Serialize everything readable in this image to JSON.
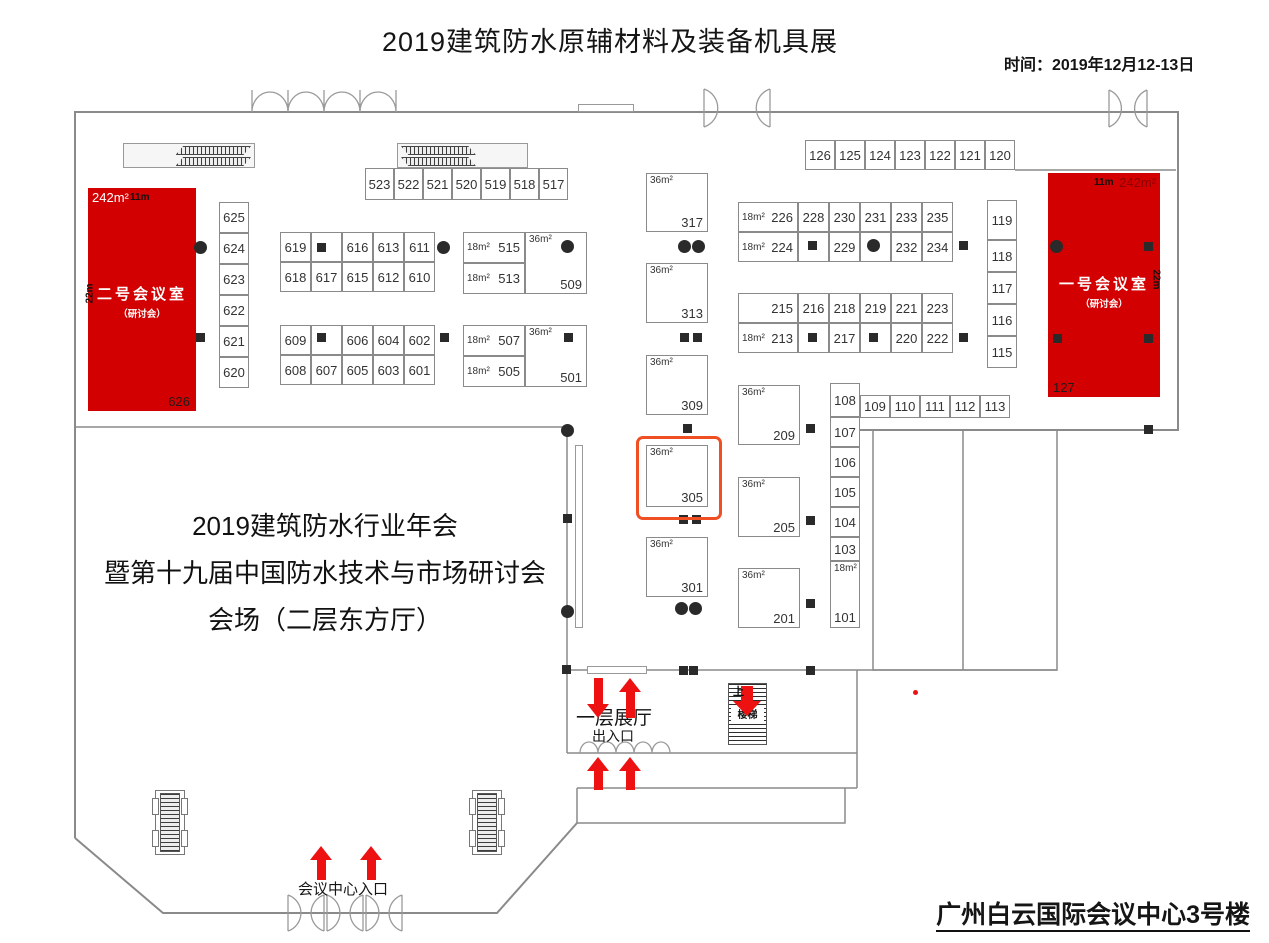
{
  "header": {
    "title": "2019建筑防水原辅材料及装备机具展",
    "time": "时间：2019年12月12-13日"
  },
  "footer": {
    "venue": "广州白云国际会议中心3号楼"
  },
  "annual_meeting": {
    "line1": "2019建筑防水行业年会",
    "line2": "暨第十九届中国防水技术与市场研讨会",
    "line3": "会场（二层东方厅）"
  },
  "labels": {
    "floor_hall": "一层展厅",
    "entrance_exit": "出入口",
    "center_entrance": "会议中心入口",
    "stairs": "楼梯",
    "up": "上"
  },
  "highlighted_booth": "305",
  "colors": {
    "room_red": "#d20000",
    "arrow_red": "#ee1111",
    "orange": "#f04f24",
    "wall": "#8a8a8a"
  },
  "conference_rooms": [
    {
      "name": "二号会议室",
      "subtitle": "（研讨会）",
      "area": "242m²",
      "width": "11m",
      "depth": "22m",
      "booth": "626"
    },
    {
      "name": "一号会议室",
      "subtitle": "（研讨会）",
      "area": "242m²",
      "width": "11m",
      "depth": "22m",
      "booth": "127"
    }
  ],
  "booths": [
    {
      "no": "523",
      "t": "c",
      "x": 365,
      "y": 168,
      "w": 29,
      "h": 32
    },
    {
      "no": "522",
      "t": "c",
      "x": 394,
      "y": 168,
      "w": 29,
      "h": 32
    },
    {
      "no": "521",
      "t": "c",
      "x": 423,
      "y": 168,
      "w": 29,
      "h": 32
    },
    {
      "no": "520",
      "t": "c",
      "x": 452,
      "y": 168,
      "w": 29,
      "h": 32
    },
    {
      "no": "519",
      "t": "c",
      "x": 481,
      "y": 168,
      "w": 29,
      "h": 32
    },
    {
      "no": "518",
      "t": "c",
      "x": 510,
      "y": 168,
      "w": 29,
      "h": 32
    },
    {
      "no": "517",
      "t": "c",
      "x": 539,
      "y": 168,
      "w": 29,
      "h": 32
    },
    {
      "no": "126",
      "t": "c",
      "x": 805,
      "y": 140,
      "w": 30,
      "h": 30
    },
    {
      "no": "125",
      "t": "c",
      "x": 835,
      "y": 140,
      "w": 30,
      "h": 30
    },
    {
      "no": "124",
      "t": "c",
      "x": 865,
      "y": 140,
      "w": 30,
      "h": 30
    },
    {
      "no": "123",
      "t": "c",
      "x": 895,
      "y": 140,
      "w": 30,
      "h": 30
    },
    {
      "no": "122",
      "t": "c",
      "x": 925,
      "y": 140,
      "w": 30,
      "h": 30
    },
    {
      "no": "121",
      "t": "c",
      "x": 955,
      "y": 140,
      "w": 30,
      "h": 30
    },
    {
      "no": "120",
      "t": "c",
      "x": 985,
      "y": 140,
      "w": 30,
      "h": 30
    },
    {
      "no": "625",
      "t": "c",
      "x": 219,
      "y": 202,
      "w": 30,
      "h": 31
    },
    {
      "no": "624",
      "t": "c",
      "x": 219,
      "y": 233,
      "w": 30,
      "h": 31
    },
    {
      "no": "623",
      "t": "c",
      "x": 219,
      "y": 264,
      "w": 30,
      "h": 31
    },
    {
      "no": "622",
      "t": "c",
      "x": 219,
      "y": 295,
      "w": 30,
      "h": 31
    },
    {
      "no": "621",
      "t": "c",
      "x": 219,
      "y": 326,
      "w": 30,
      "h": 31
    },
    {
      "no": "620",
      "t": "c",
      "x": 219,
      "y": 357,
      "w": 30,
      "h": 31
    },
    {
      "no": "619",
      "t": "c",
      "x": 280,
      "y": 232,
      "w": 31,
      "h": 30
    },
    {
      "no": "",
      "t": "c",
      "x": 311,
      "y": 232,
      "w": 31,
      "h": 30
    },
    {
      "no": "616",
      "t": "c",
      "x": 342,
      "y": 232,
      "w": 31,
      "h": 30
    },
    {
      "no": "613",
      "t": "c",
      "x": 373,
      "y": 232,
      "w": 31,
      "h": 30
    },
    {
      "no": "611",
      "t": "c",
      "x": 404,
      "y": 232,
      "w": 31,
      "h": 30
    },
    {
      "no": "618",
      "t": "c",
      "x": 280,
      "y": 262,
      "w": 31,
      "h": 30
    },
    {
      "no": "617",
      "t": "c",
      "x": 311,
      "y": 262,
      "w": 31,
      "h": 30
    },
    {
      "no": "615",
      "t": "c",
      "x": 342,
      "y": 262,
      "w": 31,
      "h": 30
    },
    {
      "no": "612",
      "t": "c",
      "x": 373,
      "y": 262,
      "w": 31,
      "h": 30
    },
    {
      "no": "610",
      "t": "c",
      "x": 404,
      "y": 262,
      "w": 31,
      "h": 30
    },
    {
      "no": "609",
      "t": "c",
      "x": 280,
      "y": 325,
      "w": 31,
      "h": 30
    },
    {
      "no": "",
      "t": "c",
      "x": 311,
      "y": 325,
      "w": 31,
      "h": 30
    },
    {
      "no": "606",
      "t": "c",
      "x": 342,
      "y": 325,
      "w": 31,
      "h": 30
    },
    {
      "no": "604",
      "t": "c",
      "x": 373,
      "y": 325,
      "w": 31,
      "h": 30
    },
    {
      "no": "602",
      "t": "c",
      "x": 404,
      "y": 325,
      "w": 31,
      "h": 30
    },
    {
      "no": "608",
      "t": "c",
      "x": 280,
      "y": 355,
      "w": 31,
      "h": 30
    },
    {
      "no": "607",
      "t": "c",
      "x": 311,
      "y": 355,
      "w": 31,
      "h": 30
    },
    {
      "no": "605",
      "t": "c",
      "x": 342,
      "y": 355,
      "w": 31,
      "h": 30
    },
    {
      "no": "603",
      "t": "c",
      "x": 373,
      "y": 355,
      "w": 31,
      "h": 30
    },
    {
      "no": "601",
      "t": "c",
      "x": 404,
      "y": 355,
      "w": 31,
      "h": 30
    },
    {
      "no": "515",
      "t": "a",
      "area": "18m²",
      "x": 463,
      "y": 232,
      "w": 62,
      "h": 31
    },
    {
      "no": "513",
      "t": "a",
      "area": "18m²",
      "x": 463,
      "y": 263,
      "w": 62,
      "h": 31
    },
    {
      "no": "509",
      "t": "b",
      "area": "36m²",
      "x": 525,
      "y": 232,
      "w": 62,
      "h": 62
    },
    {
      "no": "507",
      "t": "a",
      "area": "18m²",
      "x": 463,
      "y": 325,
      "w": 62,
      "h": 31
    },
    {
      "no": "505",
      "t": "a",
      "area": "18m²",
      "x": 463,
      "y": 356,
      "w": 62,
      "h": 31
    },
    {
      "no": "501",
      "t": "b",
      "area": "36m²",
      "x": 525,
      "y": 325,
      "w": 62,
      "h": 62
    },
    {
      "no": "317",
      "t": "b",
      "area": "36m²",
      "x": 646,
      "y": 173,
      "w": 62,
      "h": 59
    },
    {
      "no": "313",
      "t": "b",
      "area": "36m²",
      "x": 646,
      "y": 263,
      "w": 62,
      "h": 60
    },
    {
      "no": "309",
      "t": "b",
      "area": "36m²",
      "x": 646,
      "y": 355,
      "w": 62,
      "h": 60
    },
    {
      "no": "305",
      "t": "b",
      "area": "36m²",
      "x": 646,
      "y": 445,
      "w": 62,
      "h": 62
    },
    {
      "no": "301",
      "t": "b",
      "area": "36m²",
      "x": 646,
      "y": 537,
      "w": 62,
      "h": 60
    },
    {
      "no": "209",
      "t": "b",
      "area": "36m²",
      "x": 738,
      "y": 385,
      "w": 62,
      "h": 60
    },
    {
      "no": "205",
      "t": "b",
      "area": "36m²",
      "x": 738,
      "y": 477,
      "w": 62,
      "h": 60
    },
    {
      "no": "201",
      "t": "b",
      "area": "36m²",
      "x": 738,
      "y": 568,
      "w": 62,
      "h": 60
    },
    {
      "no": "226",
      "t": "a",
      "area": "18m²",
      "x": 738,
      "y": 202,
      "w": 60,
      "h": 30
    },
    {
      "no": "228",
      "t": "c",
      "x": 798,
      "y": 202,
      "w": 31,
      "h": 30
    },
    {
      "no": "230",
      "t": "c",
      "x": 829,
      "y": 202,
      "w": 31,
      "h": 30
    },
    {
      "no": "231",
      "t": "c",
      "x": 860,
      "y": 202,
      "w": 31,
      "h": 30
    },
    {
      "no": "233",
      "t": "c",
      "x": 891,
      "y": 202,
      "w": 31,
      "h": 30
    },
    {
      "no": "235",
      "t": "c",
      "x": 922,
      "y": 202,
      "w": 31,
      "h": 30
    },
    {
      "no": "224",
      "t": "a",
      "area": "18m²",
      "x": 738,
      "y": 232,
      "w": 60,
      "h": 30
    },
    {
      "no": "",
      "t": "c",
      "x": 798,
      "y": 232,
      "w": 31,
      "h": 30
    },
    {
      "no": "229",
      "t": "c",
      "x": 829,
      "y": 232,
      "w": 31,
      "h": 30
    },
    {
      "no": "",
      "t": "c",
      "x": 860,
      "y": 232,
      "w": 31,
      "h": 30
    },
    {
      "no": "232",
      "t": "c",
      "x": 891,
      "y": 232,
      "w": 31,
      "h": 30
    },
    {
      "no": "234",
      "t": "c",
      "x": 922,
      "y": 232,
      "w": 31,
      "h": 30
    },
    {
      "no": "215",
      "t": "a",
      "area": "",
      "x": 738,
      "y": 293,
      "w": 60,
      "h": 30
    },
    {
      "no": "216",
      "t": "c",
      "x": 798,
      "y": 293,
      "w": 31,
      "h": 30
    },
    {
      "no": "218",
      "t": "c",
      "x": 829,
      "y": 293,
      "w": 31,
      "h": 30
    },
    {
      "no": "219",
      "t": "c",
      "x": 860,
      "y": 293,
      "w": 31,
      "h": 30
    },
    {
      "no": "221",
      "t": "c",
      "x": 891,
      "y": 293,
      "w": 31,
      "h": 30
    },
    {
      "no": "223",
      "t": "c",
      "x": 922,
      "y": 293,
      "w": 31,
      "h": 30
    },
    {
      "no": "213",
      "t": "a",
      "area": "18m²",
      "x": 738,
      "y": 323,
      "w": 60,
      "h": 30
    },
    {
      "no": "",
      "t": "c",
      "x": 798,
      "y": 323,
      "w": 31,
      "h": 30
    },
    {
      "no": "217",
      "t": "c",
      "x": 829,
      "y": 323,
      "w": 31,
      "h": 30
    },
    {
      "no": "",
      "t": "c",
      "x": 860,
      "y": 323,
      "w": 31,
      "h": 30
    },
    {
      "no": "220",
      "t": "c",
      "x": 891,
      "y": 323,
      "w": 31,
      "h": 30
    },
    {
      "no": "222",
      "t": "c",
      "x": 922,
      "y": 323,
      "w": 31,
      "h": 30
    },
    {
      "no": "119",
      "t": "c",
      "x": 987,
      "y": 200,
      "w": 30,
      "h": 40
    },
    {
      "no": "118",
      "t": "c",
      "x": 987,
      "y": 240,
      "w": 30,
      "h": 32
    },
    {
      "no": "117",
      "t": "c",
      "x": 987,
      "y": 272,
      "w": 30,
      "h": 32
    },
    {
      "no": "116",
      "t": "c",
      "x": 987,
      "y": 304,
      "w": 30,
      "h": 32
    },
    {
      "no": "115",
      "t": "c",
      "x": 987,
      "y": 336,
      "w": 30,
      "h": 32
    },
    {
      "no": "108",
      "t": "c",
      "x": 830,
      "y": 383,
      "w": 30,
      "h": 34
    },
    {
      "no": "109",
      "t": "c",
      "x": 860,
      "y": 395,
      "w": 30,
      "h": 23
    },
    {
      "no": "110",
      "t": "c",
      "x": 890,
      "y": 395,
      "w": 30,
      "h": 23
    },
    {
      "no": "111",
      "t": "c",
      "x": 920,
      "y": 395,
      "w": 30,
      "h": 23
    },
    {
      "no": "112",
      "t": "c",
      "x": 950,
      "y": 395,
      "w": 30,
      "h": 23
    },
    {
      "no": "113",
      "t": "c",
      "x": 980,
      "y": 395,
      "w": 30,
      "h": 23
    },
    {
      "no": "107",
      "t": "c",
      "x": 830,
      "y": 417,
      "w": 30,
      "h": 30
    },
    {
      "no": "106",
      "t": "c",
      "x": 830,
      "y": 447,
      "w": 30,
      "h": 30
    },
    {
      "no": "105",
      "t": "c",
      "x": 830,
      "y": 477,
      "w": 30,
      "h": 30
    },
    {
      "no": "104",
      "t": "c",
      "x": 830,
      "y": 507,
      "w": 30,
      "h": 30
    },
    {
      "no": "103",
      "t": "c",
      "x": 830,
      "y": 537,
      "w": 30,
      "h": 24
    },
    {
      "no": "101",
      "t": "t",
      "area": "18m²",
      "x": 830,
      "y": 561,
      "w": 30,
      "h": 67
    }
  ],
  "pillars": {
    "circles": [
      [
        200,
        247
      ],
      [
        443,
        247
      ],
      [
        567,
        246
      ],
      [
        684,
        246
      ],
      [
        698,
        246
      ],
      [
        873,
        245
      ],
      [
        1056,
        246
      ],
      [
        567,
        430
      ],
      [
        567,
        611
      ],
      [
        681,
        608
      ],
      [
        695,
        608
      ]
    ],
    "squares": [
      [
        321,
        247
      ],
      [
        200,
        337
      ],
      [
        444,
        337
      ],
      [
        568,
        337
      ],
      [
        321,
        337
      ],
      [
        684,
        337
      ],
      [
        697,
        337
      ],
      [
        687,
        428
      ],
      [
        683,
        519
      ],
      [
        696,
        519
      ],
      [
        812,
        245
      ],
      [
        963,
        245
      ],
      [
        812,
        337
      ],
      [
        873,
        337
      ],
      [
        963,
        337
      ],
      [
        810,
        428
      ],
      [
        810,
        520
      ],
      [
        810,
        603
      ],
      [
        567,
        518
      ],
      [
        566,
        669
      ],
      [
        683,
        670
      ],
      [
        693,
        670
      ],
      [
        810,
        670
      ],
      [
        1148,
        429
      ],
      [
        1148,
        246
      ],
      [
        1057,
        338
      ],
      [
        1148,
        338
      ]
    ]
  },
  "arrows": [
    {
      "x": 598,
      "y": 678,
      "len": 40,
      "dir": "down",
      "wide": false
    },
    {
      "x": 630,
      "y": 678,
      "len": 40,
      "dir": "up",
      "wide": false
    },
    {
      "x": 598,
      "y": 757,
      "len": 33,
      "dir": "up",
      "wide": false
    },
    {
      "x": 630,
      "y": 757,
      "len": 33,
      "dir": "up",
      "wide": false
    },
    {
      "x": 747,
      "y": 686,
      "len": 30,
      "dir": "down",
      "wide": true
    },
    {
      "x": 321,
      "y": 846,
      "len": 34,
      "dir": "up",
      "wide": false
    },
    {
      "x": 371,
      "y": 846,
      "len": 34,
      "dir": "up",
      "wide": false
    }
  ]
}
